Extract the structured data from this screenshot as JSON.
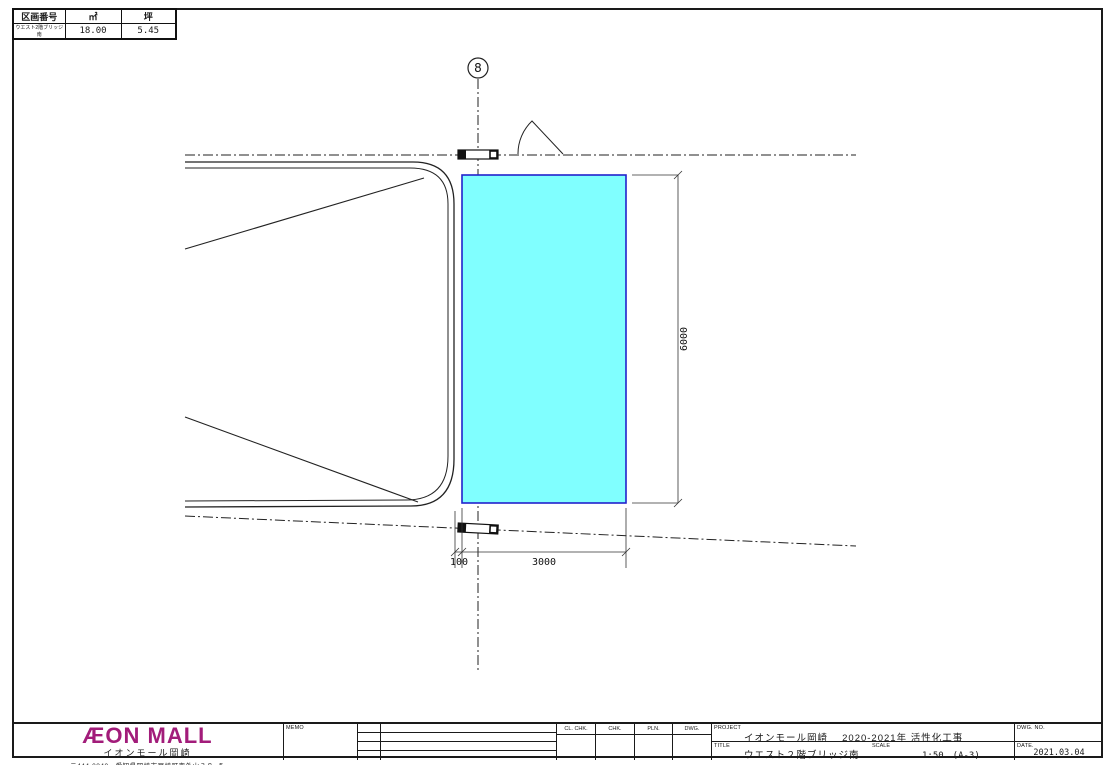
{
  "area_table": {
    "headers": [
      "区画番号",
      "㎡",
      "坪"
    ],
    "rows": [
      {
        "name": "ウエスト2階ブリッジ南",
        "sqm": "18.00",
        "tsubo": "5.45"
      }
    ]
  },
  "drawing": {
    "grid_bubble_label": "8",
    "dim_height": "6000",
    "dim_width": "3000",
    "dim_offset": "100",
    "highlight_fill": "#80FFFF",
    "highlight_border": "#2222CC"
  },
  "title_block": {
    "company": {
      "logo_text": "ÆON MALL",
      "logo_color": "#A21C7A",
      "name": "イオンモール岡崎",
      "address": "〒444-0840　愛知県岡崎市戸崎町字外山３８−５"
    },
    "memo_label": "MEMO",
    "sign_columns": [
      "CL. CHK.",
      "CHK.",
      "PLN.",
      "DWG."
    ],
    "project": {
      "label": "PROJECT",
      "value": "イオンモール岡崎　 2020-2021年 活性化工事"
    },
    "title": {
      "label": "TITLE",
      "value": "ウエスト２階ブリッジ南"
    },
    "scale": {
      "label": "SCALE",
      "value": "1:50　(A-3)"
    },
    "dwg_no": {
      "label": "DWG. NO.",
      "value": ""
    },
    "date": {
      "label": "DATE.",
      "value": "2021.03.04"
    }
  }
}
